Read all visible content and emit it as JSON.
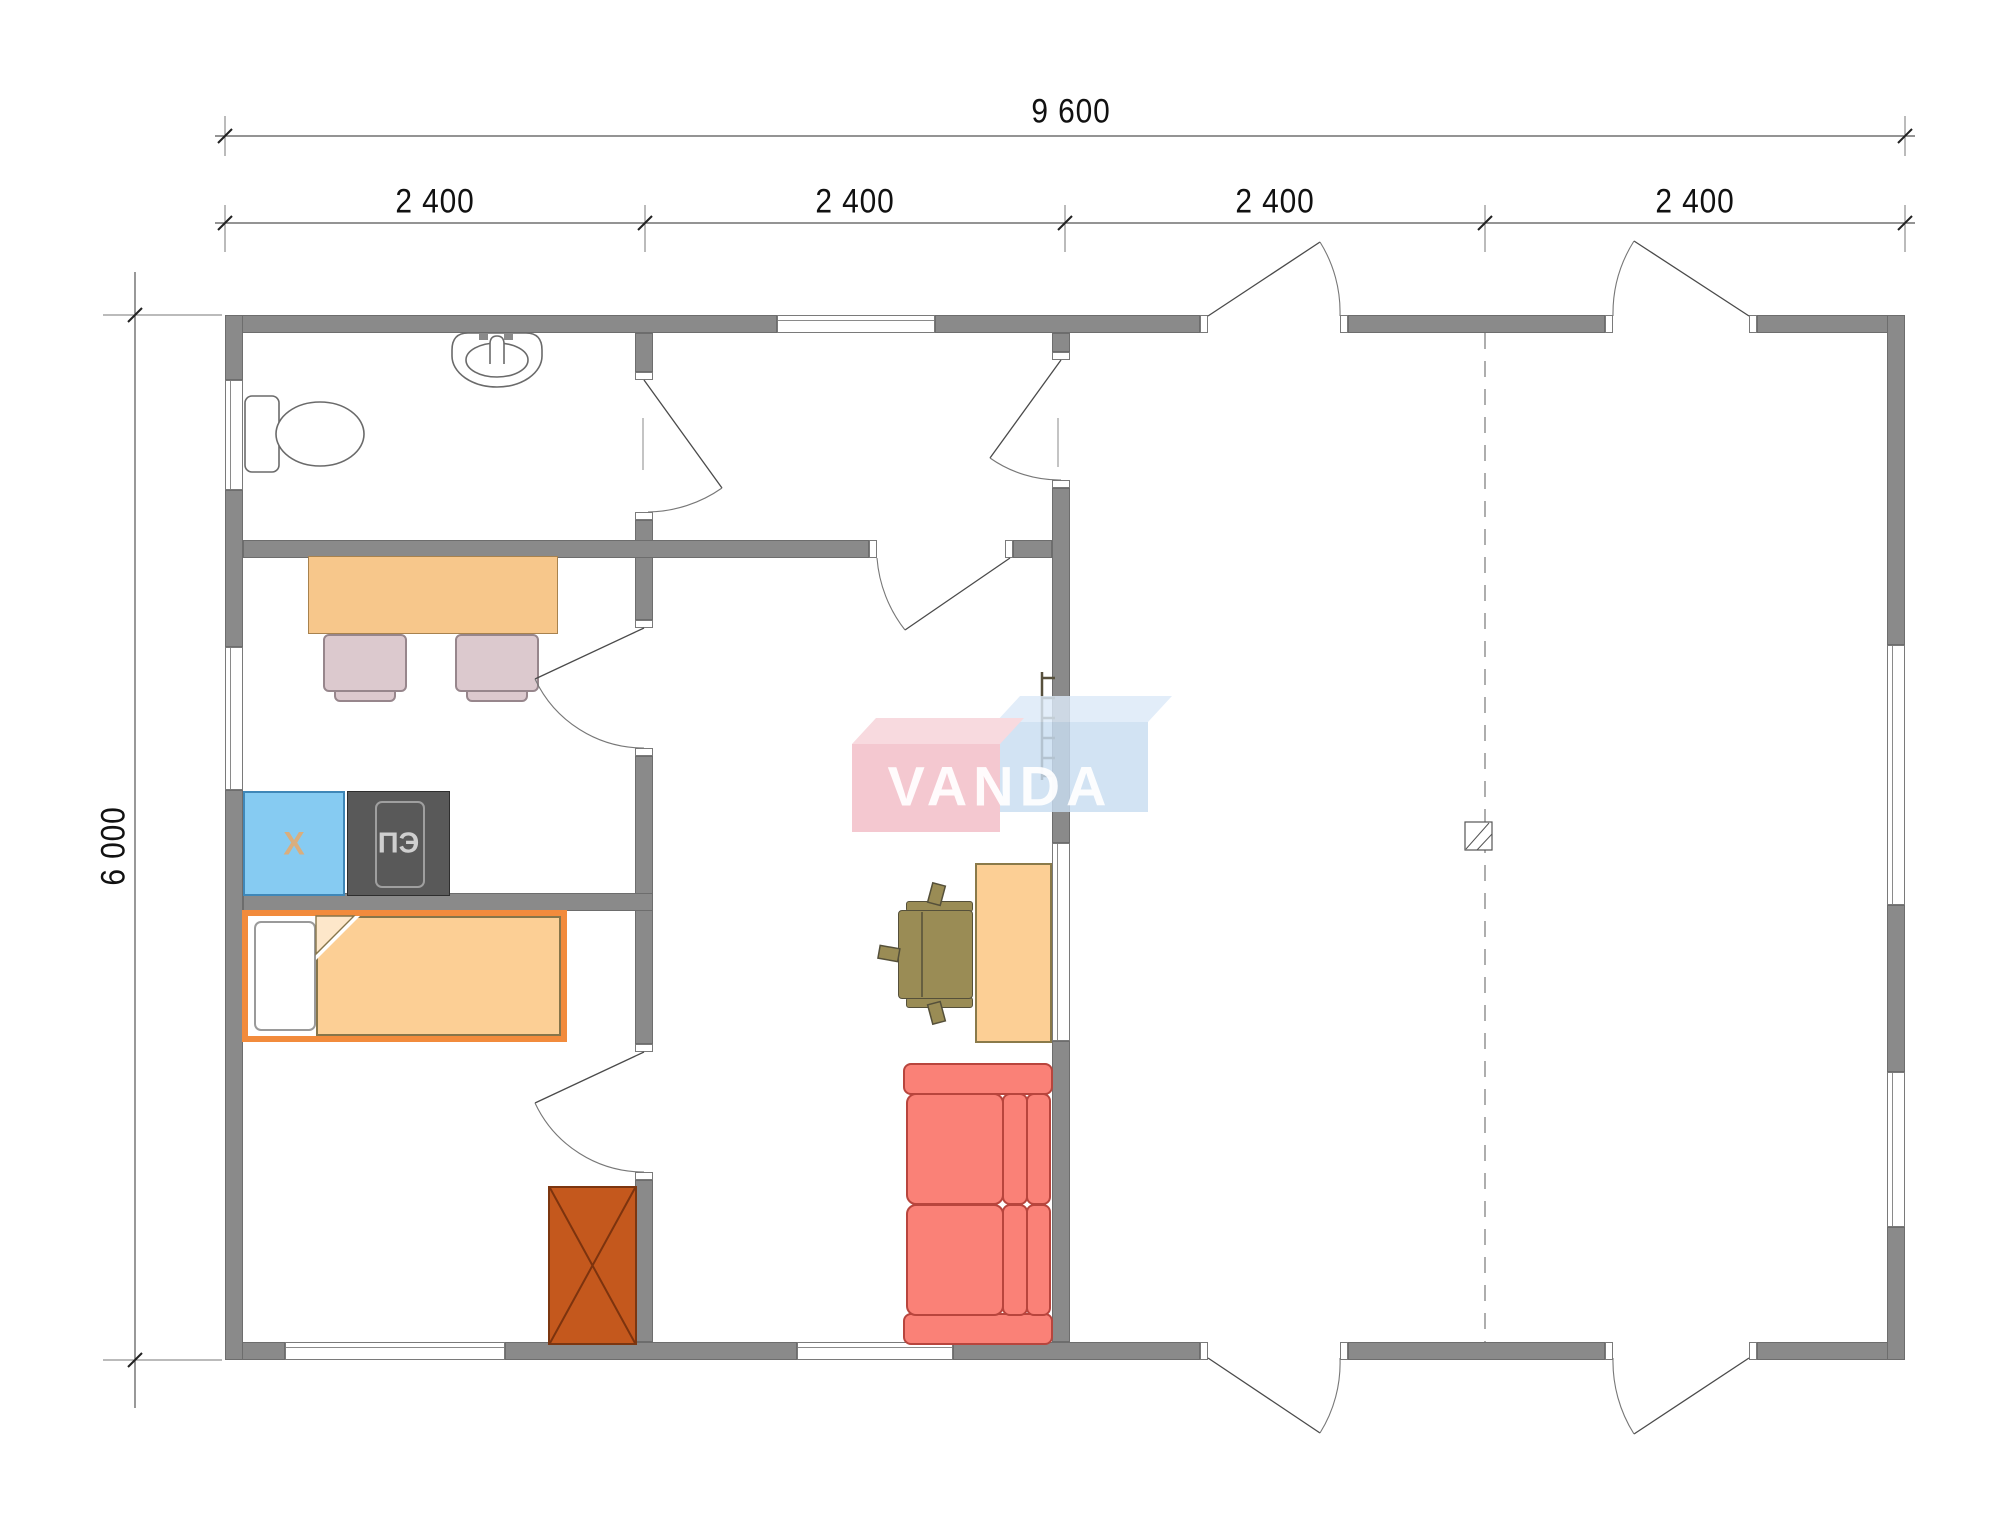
{
  "dimensions": {
    "total_width": "9 600",
    "modules": [
      "2 400",
      "2 400",
      "2 400",
      "2 400"
    ],
    "total_height": "6 000"
  },
  "watermark": {
    "text": "VANDA",
    "pink": "#F2BCC6",
    "blue": "#C9DDF1"
  },
  "kitchen": {
    "fridge_label": "X",
    "stove_label": "ПЭ"
  },
  "colors": {
    "wall": "#8a8a8a",
    "dining_table": "#F7C78B",
    "dining_chair": "#DCC9CE",
    "fridge": "#86CBF2",
    "stove": "#595959",
    "bed_frame": "#F28B3C",
    "blanket": "#FCCF95",
    "wardrobe": "#C4581D",
    "desk": "#FCCF95",
    "office_chair": "#9A8C55",
    "sofa": "#FA8177"
  }
}
